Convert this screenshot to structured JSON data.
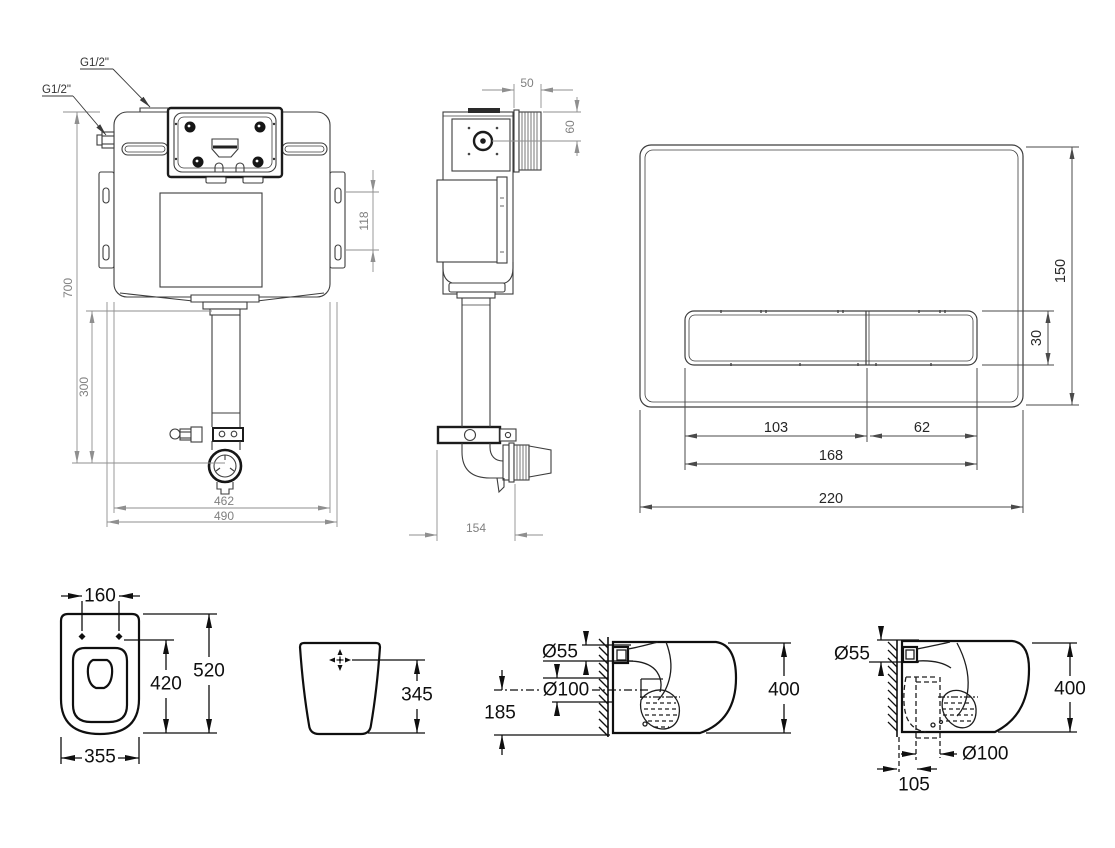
{
  "page": {
    "background": "#ffffff",
    "line_dark": "#0f0f0f",
    "line_medium": "#3d3d3d",
    "dim_gray": "#8f8f8f"
  },
  "views": {
    "cistern_front": {
      "labels": {
        "g12_top": "G1/2\"",
        "g12_left": "G1/2\"",
        "height": "700",
        "flush_pipe": "300",
        "fixing_slots": "118",
        "width_body": "462",
        "width_overall": "490"
      }
    },
    "cistern_side": {
      "labels": {
        "inlet_depth": "50",
        "inlet_offset": "60",
        "depth": "154"
      }
    },
    "flush_plate": {
      "labels": {
        "height": "150",
        "button_height": "30",
        "button_large": "103",
        "button_small": "62",
        "buttons_width": "168",
        "width": "220"
      }
    },
    "pan_top": {
      "labels": {
        "fixing_centres": "160",
        "bowl_length": "420",
        "length": "520",
        "width": "355"
      }
    },
    "pan_rear": {
      "labels": {
        "inlet_height": "345"
      }
    },
    "pan_side_wall_outlet": {
      "labels": {
        "inlet_dia": "Ø55",
        "outlet_dia": "Ø100",
        "outlet_height": "185",
        "height": "400"
      }
    },
    "pan_side_floor_outlet": {
      "labels": {
        "inlet_dia": "Ø55",
        "height": "400",
        "outlet_dia": "Ø100",
        "outlet_setout": "105"
      }
    }
  }
}
